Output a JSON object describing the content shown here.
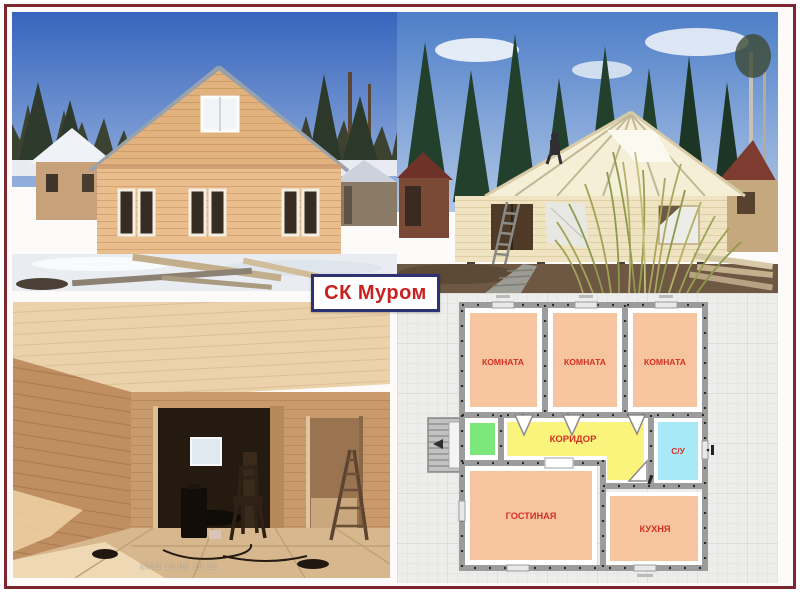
{
  "brand": {
    "label": "СК Муром",
    "text_color": "#c92121",
    "border_color": "#2e3273",
    "background": "#ffffff"
  },
  "frame": {
    "border_color": "#7a2730",
    "background": "#ffffff"
  },
  "photos": {
    "interior": {
      "timestamp": "2023.12.02 15:21"
    }
  },
  "floor_plan": {
    "grid_background": "#edEDeb",
    "wall_color": "#9c9c9c",
    "dot_color": "#2b2b2b",
    "label_color": "#d43023",
    "rooms": {
      "room1": {
        "label": "КОМНАТА",
        "fill": "#f6c49e"
      },
      "room2": {
        "label": "КОМНАТА",
        "fill": "#f6c49e"
      },
      "room3": {
        "label": "КОМНАТА",
        "fill": "#f6c49e"
      },
      "corridor": {
        "label": "КОРИДОР",
        "fill": "#faf37c"
      },
      "bathroom": {
        "label": "С/У",
        "fill": "#a8e9f7"
      },
      "living": {
        "label": "ГОСТИНАЯ",
        "fill": "#f6c49e"
      },
      "kitchen": {
        "label": "КУХНЯ",
        "fill": "#f6c49e"
      },
      "entry": {
        "label": "",
        "fill": "#7ce87c"
      }
    }
  }
}
